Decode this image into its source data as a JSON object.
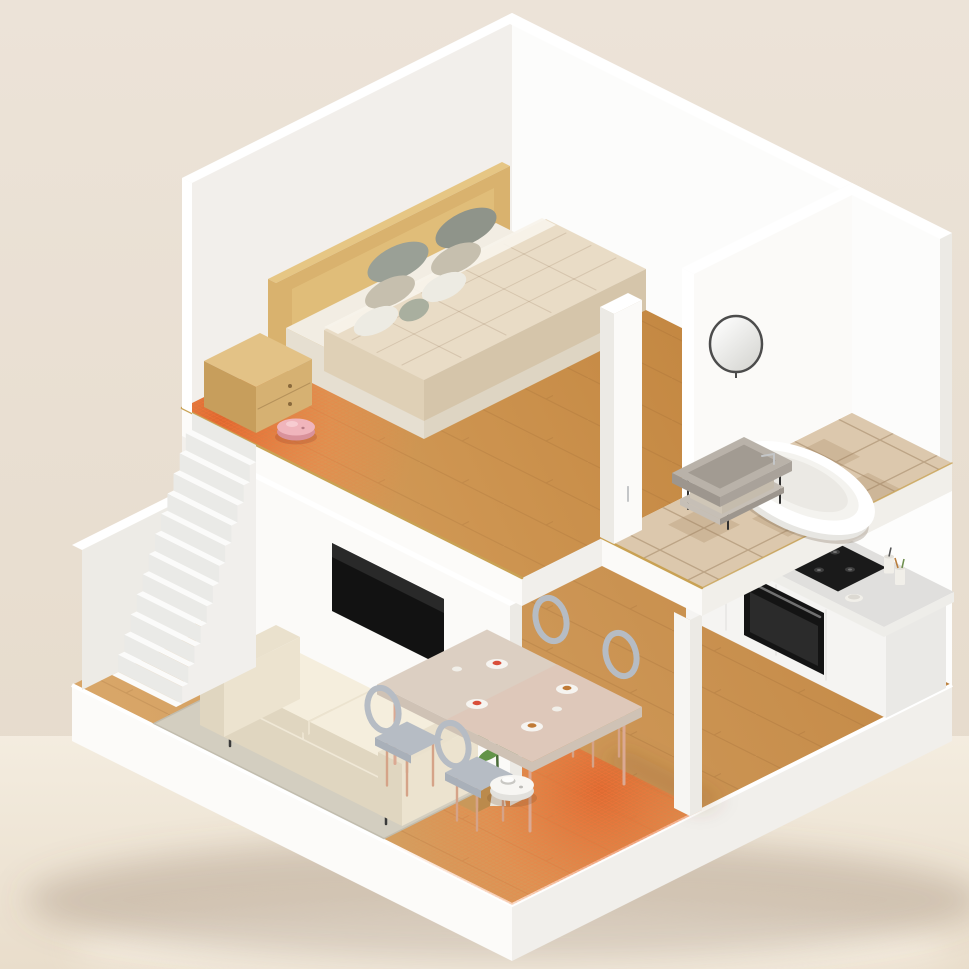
{
  "scene": {
    "description": "3D isometric cutaway dollhouse render of a two-story smart home: upstairs bedroom with double bed and a pink robot vacuum on an orange heat-map coverage zone, tiled bathroom with oval tub, round mirror and vanity rack; downstairs living room with cream sofa, rug, wall TV, media console and potted plant, dining area with table, four grey chairs and an orange heat-map coverage zone, white kitchen counter with gas hob and oven, white staircase, and a white robot vacuum cleaning the wood floor.",
    "style": "isometric-cutaway-architectural-render",
    "floors": [
      {
        "name": "upper-floor",
        "rooms": [
          {
            "name": "bedroom",
            "items": [
              "double-bed",
              "wood-headboard",
              "six-pillows",
              "wood-nightstand",
              "pink-robot-vacuum",
              "orange-heatmap-coverage-zone",
              "wood-floor",
              "gold-floor-trim"
            ]
          },
          {
            "name": "bathroom",
            "items": [
              "oval-bathtub",
              "round-mirror",
              "vanity-rack",
              "beige-tile-floor",
              "chrome-faucet",
              "doorway"
            ]
          }
        ]
      },
      {
        "name": "ground-floor",
        "rooms": [
          {
            "name": "living-room",
            "items": [
              "cream-sofa",
              "area-rug",
              "wall-mounted-tv",
              "wood-media-console",
              "potted-plant",
              "white-robot-vacuum"
            ]
          },
          {
            "name": "dining-area",
            "items": [
              "dining-table",
              "four-grey-chairs",
              "plates-and-cups",
              "orange-heatmap-coverage-zone"
            ]
          },
          {
            "name": "kitchen",
            "items": [
              "white-cabinet-counter",
              "gas-hob",
              "built-in-oven",
              "utensil-cups",
              "fruit-plate",
              "bowl"
            ]
          }
        ]
      }
    ],
    "connections": [
      "white-staircase"
    ]
  },
  "palette": {
    "bgA": "#ece3d8",
    "bgB": "#e5daca",
    "glossA": "#f4ede0",
    "glossB": "#e9ddcb",
    "reflection": "#fffaf0",
    "shadowUnder": "rgba(125,100,75,0.25)",
    "shadowSoft": "rgba(110,70,40,0.20)",
    "slabL": "#fcfbf9",
    "slabR": "#f1efeb",
    "woodA": "#dcab6e",
    "woodB": "#c08440",
    "woodA2": "#d8a260",
    "woodB2": "#bd7f38",
    "plankLine": "rgba(115,70,28,0.28)",
    "floorRim": "#ffffff",
    "wallInnerL": "#f3f0ec",
    "wallInnerR": "#fdfdfc",
    "wallUpperL": "#f2efeb",
    "wallUpperR": "#fcfcfb",
    "wallCap": "#ffffff",
    "wallEnd": "#eceae5",
    "tvWall": "#fbfaf8",
    "returnWall": "#edebe6",
    "columnFace": "#f7f6f3",
    "stairTread": "#fbfbfa",
    "stairRiser": "#eaeae7",
    "stairSide": "#f1efec",
    "goldTrim": "#c9a254",
    "heatCore": "#df5f28",
    "heatMid": "#ea8c4e",
    "heatGrid": "rgba(255,116,56,0.55)",
    "tileBase": "#dcc8ad",
    "tileLine": "rgba(150,120,85,0.5)",
    "tileDark": "rgba(160,128,92,0.25)",
    "tileFasciaF": "#fbfaf8",
    "tileFasciaR": "#f1efea",
    "headboard": "#d9b26e",
    "headboardTop": "#e6c684",
    "mattressTop": "#f2ede3",
    "mattressL": "#e6dfd1",
    "mattressR": "#ded5c3",
    "duvetTop": "#e9dcc6",
    "duvetL": "#dfd0b6",
    "duvetR": "#d5c5aa",
    "sheet": "#f7f3ea",
    "quiltLine": "rgba(130,95,60,0.18)",
    "pillowGrey": "#8f948a",
    "pillowGrey2": "#9aa096",
    "pillowBeige": "#c6bfae",
    "pillowWhite": "#edebe3",
    "pillowSage": "#a9af9f",
    "nightTop": "#e3c286",
    "nightFront": "#d6b172",
    "nightSide": "#c79e5c",
    "knob": "#8a6a3c",
    "robotPinkTop": "#f0b5bc",
    "robotPinkSide": "#d9929b",
    "robotPinkLid": "#f7ccd1",
    "robotPinkDot": "#b87d86",
    "robotWhiteTop": "#f7f6f3",
    "robotWhiteSide": "#e2e1dd",
    "lidar": "#fdfdfc",
    "robotRing": "#c9c8c4",
    "mirrorRim": "#4c4c4c",
    "mirrorA": "#ffffff",
    "mirrorB": "#d6d6d2",
    "vanityTop": "#b9b2a9",
    "vanityFace": "#a9a29a",
    "vanitySide": "#9d968e",
    "vanitySink": "#a29b92",
    "vanityShelf": "#c6bfb6",
    "vanityBasket": "#d9d0c1",
    "vanityLeg": "#303030",
    "chrome": "#c4c6c8",
    "tubWhite": "#ffffff",
    "tubShade": "#e7e6e2",
    "tubInner": "#f4f3ef",
    "tubInner2": "#ebe9e4",
    "tubShadow": "rgba(120,100,80,0.28)",
    "sofaBase": "#f0e8d6",
    "sofaSeat": "#f5eedd",
    "sofaBack": "#f7f1e2",
    "sofaArm": "#eae1cd",
    "sofaShade": "#e0d6c0",
    "sofaSide": "#ece3cf",
    "sofaLeg": "#3a3a3a",
    "remote": "#fbfaf6",
    "rug": "#d3cec0",
    "rugEdge": "#c2bdae",
    "tv": "#121212",
    "tvSheen": "#2e2e2e",
    "consoleTop": "#d8a968",
    "consoleFront": "#c9985a",
    "consoleSide": "#bb8a4c",
    "consoleLine": "rgba(90,60,25,0.3)",
    "leaf": "#4e7e3b",
    "leaf2": "#639449",
    "stem": "#4a6b38",
    "pot": "#eae6dc",
    "potShade": "#d9d4c8",
    "tableTop": "#dccfc2",
    "tableTint": "#e0c2b2",
    "tableEdge": "#cfc2b5",
    "tableLeg": "#dba993",
    "chairSeat": "#b6bcc4",
    "chairSeat2": "#a9b0b9",
    "chairLeg": "#d5a388",
    "cabinet": "#f5f4f2",
    "cabinetShade": "#eae9e6",
    "counterTop": "#e0dfdd",
    "counterEdge": "#eeede9",
    "cabinetLine": "rgba(0,0,0,0.06)",
    "hob": "#1a1a1a",
    "burner": "#3e3e3e",
    "burnerCap": "#737373",
    "oven": "#141414",
    "ovenGlass": "#2b2b2b",
    "ovenHandle": "#707070",
    "plate": "#f6f4f0",
    "foodA": "#c07a36",
    "foodB": "#d94f3a",
    "foodC": "#7aa84a",
    "cup": "#f1efe9"
  }
}
